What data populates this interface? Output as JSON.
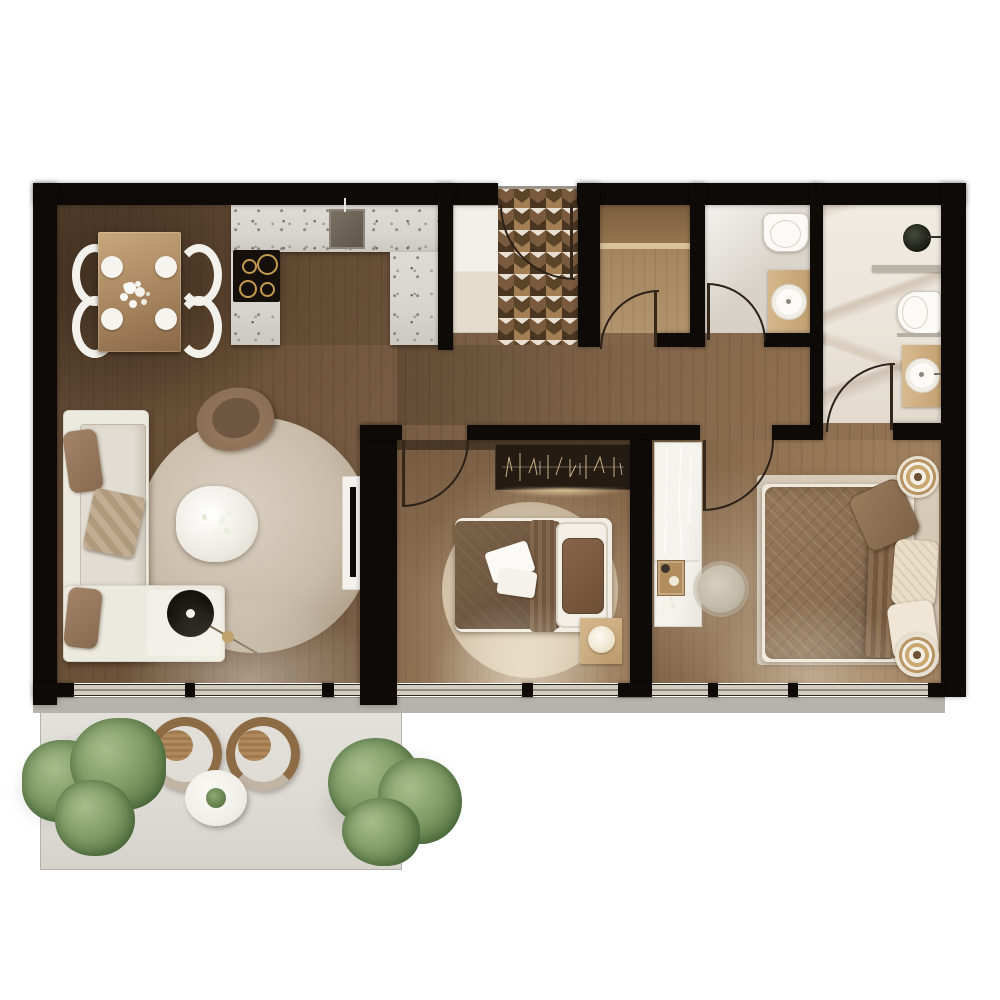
{
  "image_type": "architectural floor plan, top-down 3D render, no visible text",
  "palette": {
    "wall": "#0d0a07",
    "wood-dark": "#55412e",
    "wood-mid": "#7d6249",
    "wood-light": "#9a7c5c",
    "tile-brown": "#7a5a3d",
    "tile-light-brown": "#a37e52",
    "tile-dark": "#4a3521",
    "tile-cream": "#e8e0d2",
    "counter-terrazzo": "#d8d5d0",
    "marble": "#ebe5db",
    "wc-floor": "#d6d0c6",
    "sill-gray": "#b6b2ac",
    "balcony-slab": "#dedbd5",
    "plant-green": "#7f9c66",
    "plant-green-dark": "#5e7c49",
    "sofa-cream": "#eceade",
    "cushion-beige": "#e2ddd2",
    "pillow-brown": "#97795c",
    "rug-beige": "#c9bca9",
    "duvet-brown": "#6e5640",
    "master-duvet": "#8a6e52",
    "pillow-cream": "#e9ddc8",
    "furn-wood": "#c7a87c",
    "hob-gold": "#c49a4e",
    "line-dark": "#2b2118",
    "fixture-white": "#fbfaf7"
  },
  "rooms": [
    {
      "id": "living-dining",
      "label": "Living / Dining",
      "furniture": [
        "dining table",
        "4 chairs",
        "flower centerpiece",
        "L-sofa",
        "round rug",
        "coffee table",
        "armchair",
        "arc floor lamp",
        "tv console"
      ]
    },
    {
      "id": "kitchen",
      "label": "Kitchen",
      "furniture": [
        "u-shaped terrazzo counter",
        "sink",
        "cooktop 4 burners",
        "tall cabinet"
      ]
    },
    {
      "id": "entry-hall",
      "label": "Entry Hall",
      "furniture": [
        "chevron tile floor",
        "entry door"
      ]
    },
    {
      "id": "closet",
      "label": "Storage Closet",
      "furniture": [
        "shelf"
      ]
    },
    {
      "id": "wc",
      "label": "Guest WC",
      "furniture": [
        "toilet",
        "vanity sink"
      ]
    },
    {
      "id": "bathroom",
      "label": "Ensuite Bathroom",
      "furniture": [
        "round basin",
        "partition shelf",
        "toilet",
        "vanity sink"
      ]
    },
    {
      "id": "bedroom-1",
      "label": "Bedroom",
      "furniture": [
        "wall art",
        "double bed",
        "round rug",
        "nightstand lamp"
      ]
    },
    {
      "id": "master-bedroom",
      "label": "Master Bedroom",
      "furniture": [
        "glass-top dresser",
        "tray",
        "pouf",
        "large bed",
        "area rug",
        "2 round side tables"
      ]
    },
    {
      "id": "balcony",
      "label": "Balcony",
      "furniture": [
        "2 wicker chairs",
        "round table",
        "potted plant",
        "2 bushes"
      ]
    }
  ]
}
